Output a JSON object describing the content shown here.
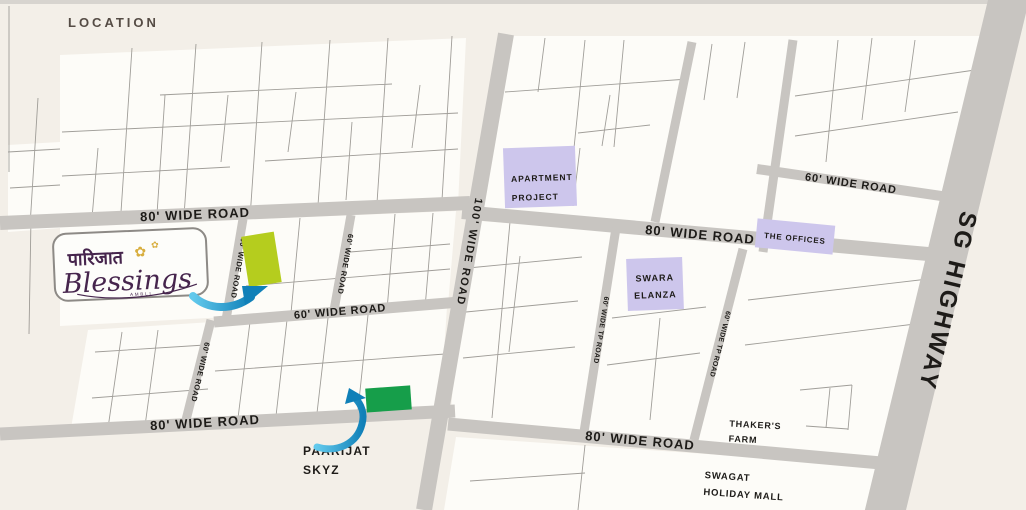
{
  "header": {
    "title": "LOCATION"
  },
  "logo": {
    "devanagari": "पारिजात",
    "name": "Blessings",
    "subtext": "AMBLI"
  },
  "roads": {
    "top_left_80": "80' WIDE ROAD",
    "top_right_80": "80' WIDE ROAD",
    "upper_right_60": "60' WIDE ROAD",
    "central_100": "100' WIDE ROAD",
    "sg_highway": "SG HIGHWAY",
    "vertical_60_a": "60' WIDE ROAD",
    "vertical_60_b": "60' WIDE ROAD",
    "mid_60": "60' WIDE ROAD",
    "vertical_60_c": "60' WIDE ROAD",
    "bottom_left_80": "80' WIDE ROAD",
    "bottom_right_80": "80' WIDE ROAD",
    "tp_road_a": "60' WIDE TP ROAD",
    "tp_road_b": "60' WIDE TP ROAD"
  },
  "landmarks": {
    "apartment_project": {
      "line1": "APARTMENT",
      "line2": "PROJECT"
    },
    "the_offices": {
      "label": "THE OFFICES"
    },
    "swara_elanza": {
      "line1": "SWARA",
      "line2": "ELANZA"
    },
    "thakers_farm": {
      "line1": "THAKER'S",
      "line2": "FARM"
    },
    "swagat_holiday_mall": {
      "line1": "SWAGAT",
      "line2": "HOLIDAY MALL"
    },
    "paarijat_skyz": {
      "line1": "PAARIJAT",
      "line2": "SKYZ"
    }
  },
  "colors": {
    "background": "#f3efe8",
    "block_fill": "#fdfcf8",
    "parcel_line": "#96938e",
    "road": "#c8c5c1",
    "road_label": "#1d1b18",
    "landmark_fill": "#cdc6ec",
    "landmark_text": "#1d1b18",
    "plot_blessings": "#b5cd1e",
    "plot_skyz": "#169e4a",
    "arrow_light": "#62c9ec",
    "arrow_dark": "#1080b8",
    "logo_purple": "#46254d",
    "logo_gold": "#d8ae3e",
    "title_text": "#554c45"
  }
}
